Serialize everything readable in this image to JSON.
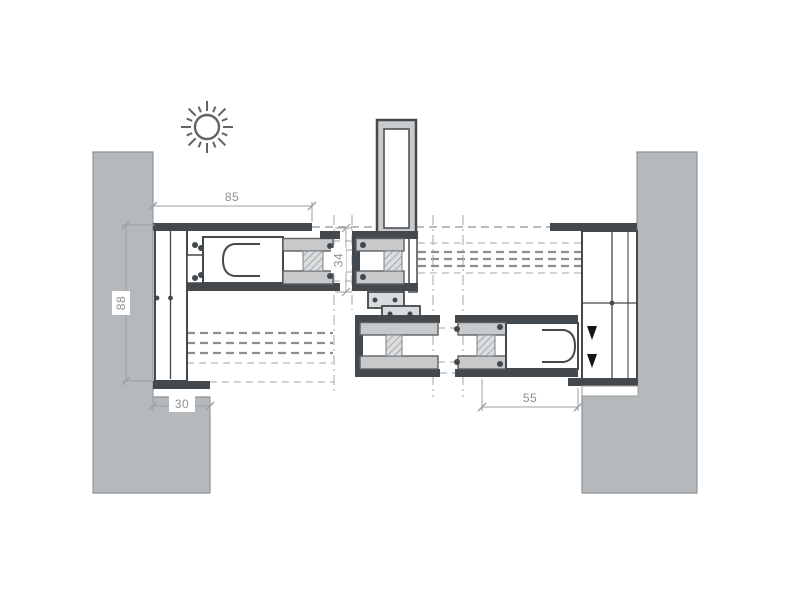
{
  "drawing": {
    "type": "technical-section-diagram",
    "subject": "aluminium sliding window system - horizontal profile cross-section at wall jambs and interlock",
    "sun_icon": "sun-icon (exterior side indicator)",
    "dimensions": {
      "top": {
        "label": "85",
        "orientation": "horizontal",
        "location": "left frame overall"
      },
      "left": {
        "label": "88",
        "orientation": "vertical",
        "location": "left frame depth"
      },
      "bottom_left": {
        "label": "30",
        "orientation": "horizontal",
        "location": "wall overlap"
      },
      "bottom_right": {
        "label": "55",
        "orientation": "horizontal",
        "location": "sliding sash width"
      },
      "glazing": {
        "label": "34",
        "orientation": "vertical",
        "location": "glazing unit thickness"
      }
    },
    "colors": {
      "background": "#ffffff",
      "wall_fill": "#b6b9bb",
      "profile_outline": "#44494d",
      "profile_fill": "#d9dbdc",
      "glass_fill": "#c7c9cb",
      "phantom_line_bold": "#8a8f92",
      "phantom_line_light": "#b3b7ba",
      "dimension_line": "#9aa0a3",
      "dimension_text": "#8b9094",
      "arrow_fill": "#151515"
    }
  }
}
